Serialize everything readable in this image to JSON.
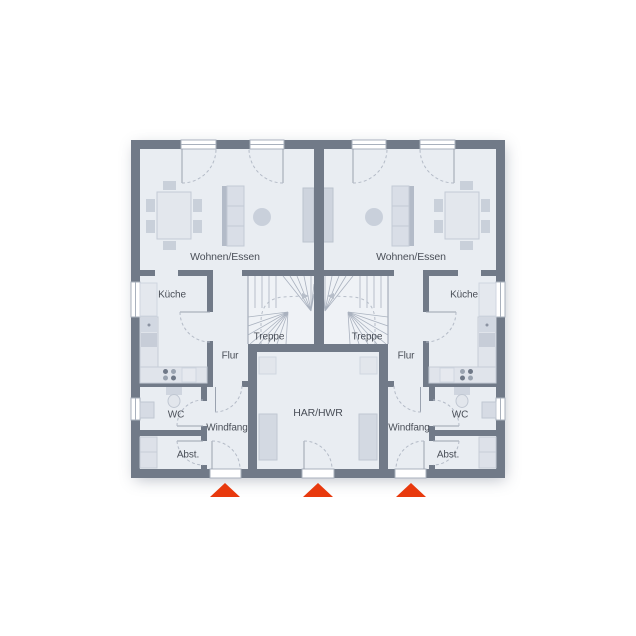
{
  "rooms": {
    "living": "Wohnen/Essen",
    "kitchen": "Küche",
    "stairs": "Treppe",
    "hall": "Flur",
    "wc": "WC",
    "vestibule": "Windfang",
    "storage": "Abst.",
    "utility": "HAR/HWR"
  },
  "colors": {
    "wall": "#717a88",
    "floor": "#e9edf2",
    "furniture_light": "#e0e4eb",
    "furniture_mid": "#c9d0da",
    "window_frame": "#a9b1bd",
    "entrance_marker": "#e8390d",
    "text": "#4a4f58"
  },
  "markers": {
    "entrance_count": 3
  }
}
